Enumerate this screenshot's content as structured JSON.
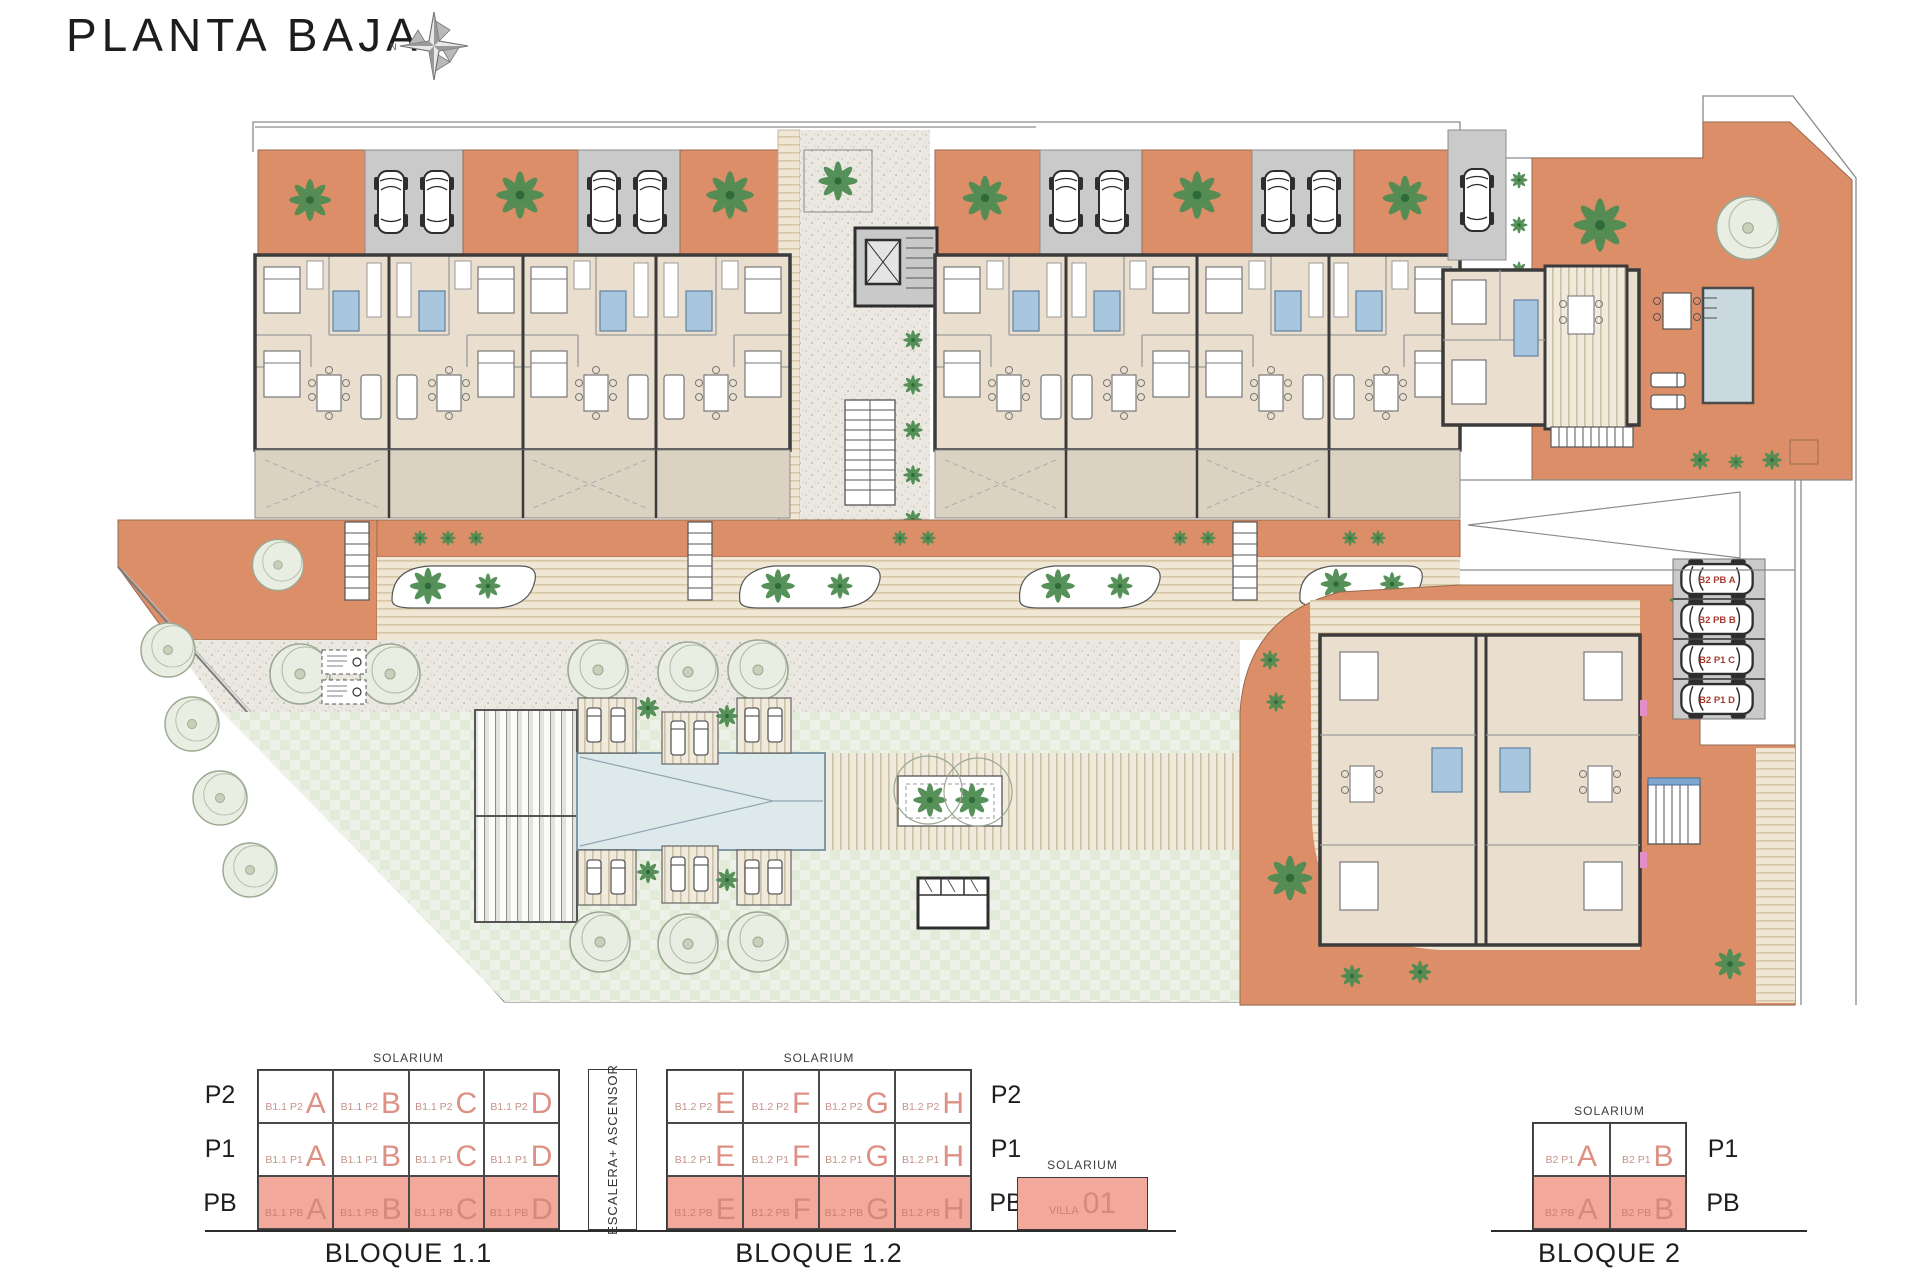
{
  "title": "PLANTA BAJA",
  "compass": {
    "north": "N"
  },
  "plan": {
    "parking_labels": [
      "B2 PB A",
      "B2 PB B",
      "B2 P1 C",
      "B2 P1 D"
    ]
  },
  "legend": {
    "escalera": "ESCALERA+ ASCENSOR",
    "bloque11": {
      "caption": "BLOQUE 1.1",
      "solarium": "SOLARIUM",
      "row_labels": [
        "P2",
        "P1",
        "PB"
      ],
      "rows": [
        {
          "cells": [
            {
              "prefix": "B1.1 P2",
              "letter": "A"
            },
            {
              "prefix": "B1.1 P2",
              "letter": "B"
            },
            {
              "prefix": "B1.1 P2",
              "letter": "C"
            },
            {
              "prefix": "B1.1 P2",
              "letter": "D"
            }
          ]
        },
        {
          "cells": [
            {
              "prefix": "B1.1 P1",
              "letter": "A"
            },
            {
              "prefix": "B1.1 P1",
              "letter": "B"
            },
            {
              "prefix": "B1.1 P1",
              "letter": "C"
            },
            {
              "prefix": "B1.1 P1",
              "letter": "D"
            }
          ]
        },
        {
          "cells": [
            {
              "prefix": "B1.1 PB",
              "letter": "A"
            },
            {
              "prefix": "B1.1 PB",
              "letter": "B"
            },
            {
              "prefix": "B1.1 PB",
              "letter": "C"
            },
            {
              "prefix": "B1.1 PB",
              "letter": "D"
            }
          ]
        }
      ]
    },
    "bloque12": {
      "caption": "BLOQUE 1.2",
      "solarium": "SOLARIUM",
      "row_labels": [
        "P2",
        "P1",
        "PB"
      ],
      "rows": [
        {
          "cells": [
            {
              "prefix": "B1.2 P2",
              "letter": "E"
            },
            {
              "prefix": "B1.2 P2",
              "letter": "F"
            },
            {
              "prefix": "B1.2 P2",
              "letter": "G"
            },
            {
              "prefix": "B1.2 P2",
              "letter": "H"
            }
          ]
        },
        {
          "cells": [
            {
              "prefix": "B1.2 P1",
              "letter": "E"
            },
            {
              "prefix": "B1.2 P1",
              "letter": "F"
            },
            {
              "prefix": "B1.2 P1",
              "letter": "G"
            },
            {
              "prefix": "B1.2 P1",
              "letter": "H"
            }
          ]
        },
        {
          "cells": [
            {
              "prefix": "B1.2 PB",
              "letter": "E"
            },
            {
              "prefix": "B1.2 PB",
              "letter": "F"
            },
            {
              "prefix": "B1.2 PB",
              "letter": "G"
            },
            {
              "prefix": "B1.2 PB",
              "letter": "H"
            }
          ]
        }
      ]
    },
    "villa": {
      "solarium": "SOLARIUM",
      "prefix": "VILLA",
      "number": "01"
    },
    "bloque2": {
      "caption": "BLOQUE 2",
      "solarium": "SOLARIUM",
      "row_labels": [
        "P1",
        "PB"
      ],
      "rows": [
        {
          "cells": [
            {
              "prefix": "B2 P1",
              "letter": "A"
            },
            {
              "prefix": "B2 P1",
              "letter": "B"
            }
          ]
        },
        {
          "cells": [
            {
              "prefix": "B2 PB",
              "letter": "A"
            },
            {
              "prefix": "B2 PB",
              "letter": "B"
            }
          ]
        }
      ]
    }
  },
  "colors": {
    "terracotta": "#DC8E68",
    "salmon_fill": "#F2A89B",
    "unit_red_text": "#DD9184",
    "parking_label_red": "#A63A30",
    "bath_blue": "#A9C6DF",
    "pool_blue": "#DEE9EC",
    "lawn_green": "#E9EEE3",
    "wall_dark": "#3B3B3B"
  }
}
